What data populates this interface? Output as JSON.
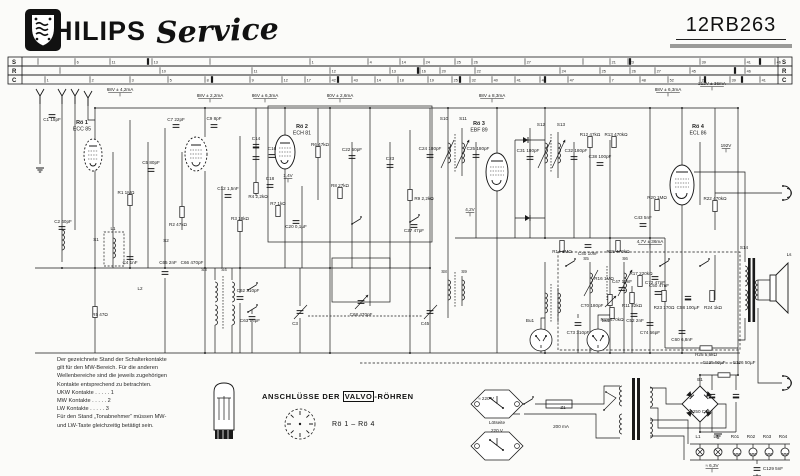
{
  "header": {
    "brand": "PHILIPS",
    "brand_script": "Service",
    "model": "12RB263"
  },
  "ruler": {
    "rows": [
      {
        "label": "S",
        "ticks": [
          [
            38,
            ""
          ],
          [
            75,
            "6"
          ],
          [
            110,
            "11"
          ],
          [
            152,
            "13"
          ],
          [
            210,
            ""
          ],
          [
            310,
            "1"
          ],
          [
            368,
            "4"
          ],
          [
            400,
            "14"
          ],
          [
            424,
            "24"
          ],
          [
            455,
            "25"
          ],
          [
            472,
            "26"
          ],
          [
            525,
            "27"
          ],
          [
            583,
            ""
          ],
          [
            610,
            "21"
          ],
          [
            628,
            "23"
          ],
          [
            700,
            "39"
          ],
          [
            745,
            "41"
          ],
          [
            775,
            "46"
          ]
        ],
        "heavy": [
          148,
          630,
          760
        ]
      },
      {
        "label": "R",
        "ticks": [
          [
            60,
            ""
          ],
          [
            160,
            "10"
          ],
          [
            252,
            "11"
          ],
          [
            330,
            "12"
          ],
          [
            390,
            "13"
          ],
          [
            420,
            "16"
          ],
          [
            440,
            "20"
          ],
          [
            475,
            "22"
          ],
          [
            560,
            "24"
          ],
          [
            600,
            "25"
          ],
          [
            630,
            "26"
          ],
          [
            655,
            "27"
          ],
          [
            690,
            "45"
          ],
          [
            745,
            "46"
          ]
        ],
        "heavy": [
          418,
          735
        ]
      },
      {
        "label": "C",
        "ticks": [
          [
            45,
            "1"
          ],
          [
            90,
            "2"
          ],
          [
            130,
            "3"
          ],
          [
            168,
            "5"
          ],
          [
            205,
            "8"
          ],
          [
            250,
            "9"
          ],
          [
            282,
            "12"
          ],
          [
            305,
            "17"
          ],
          [
            330,
            "42"
          ],
          [
            352,
            "43"
          ],
          [
            375,
            "14"
          ],
          [
            398,
            "18"
          ],
          [
            428,
            "19"
          ],
          [
            452,
            "25"
          ],
          [
            470,
            "32"
          ],
          [
            492,
            "40"
          ],
          [
            515,
            "41"
          ],
          [
            540,
            "44"
          ],
          [
            568,
            "47"
          ],
          [
            610,
            "7"
          ],
          [
            640,
            "48"
          ],
          [
            668,
            "52"
          ],
          [
            700,
            "27"
          ],
          [
            730,
            "39"
          ],
          [
            760,
            "41"
          ]
        ],
        "heavy": [
          212,
          338,
          460,
          545,
          705,
          742
        ]
      }
    ]
  },
  "schematic": {
    "tubes": [
      {
        "x": 82,
        "y": 124,
        "ref": "Rö 1",
        "type": "ECC 85"
      },
      {
        "x": 302,
        "y": 128,
        "ref": "Rö 2",
        "type": "ECH 81"
      },
      {
        "x": 479,
        "y": 125,
        "ref": "Rö 3",
        "type": "EBF 89"
      },
      {
        "x": 698,
        "y": 128,
        "ref": "Rö 4",
        "type": "ECL 86"
      }
    ],
    "annotations": [
      [
        120,
        91,
        "68V ± 4,2mA"
      ],
      [
        210,
        97,
        "88V ± 2,2mA"
      ],
      [
        265,
        97,
        "86V ± 6,3mA"
      ],
      [
        340,
        97,
        "80V ± 2,6mA"
      ],
      [
        492,
        97,
        "88V ± 8,3mA"
      ],
      [
        668,
        91,
        "88V ± 6,3mA"
      ],
      [
        712,
        85,
        "212V ± 36mA"
      ],
      [
        726,
        147,
        "192V"
      ],
      [
        650,
        243,
        "4,7V ± 36mA"
      ],
      [
        288,
        177,
        "1,4V"
      ],
      [
        470,
        211,
        "4,2V"
      ],
      [
        712,
        467,
        "≈ 6,3V"
      ]
    ],
    "labels": [
      [
        52,
        121,
        "C1 15pF"
      ],
      [
        63,
        223,
        "C2 40pF"
      ],
      [
        96,
        241,
        "S1"
      ],
      [
        113,
        230,
        "L1"
      ],
      [
        126,
        194,
        "R1 1MΩ"
      ],
      [
        130,
        264,
        "C4 1nF"
      ],
      [
        151,
        164,
        "C5 80pF"
      ],
      [
        166,
        242,
        "S2"
      ],
      [
        176,
        121,
        "C7 22pF"
      ],
      [
        178,
        226,
        "R2 47kΩ"
      ],
      [
        214,
        120,
        "C9 8pF"
      ],
      [
        228,
        190,
        "C12 1,5nF"
      ],
      [
        240,
        220,
        "R3 18kΩ"
      ],
      [
        256,
        140,
        "C14"
      ],
      [
        258,
        198,
        "R4 2,2kΩ"
      ],
      [
        272,
        150,
        "C16"
      ],
      [
        320,
        146,
        "R6 47kΩ"
      ],
      [
        270,
        180,
        "C18"
      ],
      [
        278,
        205,
        "R7 1kΩ"
      ],
      [
        296,
        228,
        "C20 0,1µF"
      ],
      [
        340,
        187,
        "R8 27kΩ"
      ],
      [
        352,
        151,
        "C22 50pF"
      ],
      [
        390,
        160,
        "C23"
      ],
      [
        444,
        120,
        "S10"
      ],
      [
        463,
        120,
        "S11"
      ],
      [
        430,
        150,
        "C24 180pF"
      ],
      [
        478,
        150,
        "C25 180pF"
      ],
      [
        424,
        200,
        "R9 2,2kΩ"
      ],
      [
        414,
        232,
        "C27 47pF"
      ],
      [
        541,
        126,
        "S12"
      ],
      [
        561,
        126,
        "S13"
      ],
      [
        528,
        152,
        "C31 180pF"
      ],
      [
        576,
        152,
        "C32 180pF"
      ],
      [
        590,
        136,
        "R12 47kΩ"
      ],
      [
        616,
        136,
        "R13 470kΩ"
      ],
      [
        600,
        158,
        "C38 100pF"
      ],
      [
        562,
        253,
        "R14 1MΩ"
      ],
      [
        588,
        255,
        "C40 10nF"
      ],
      [
        618,
        253,
        "R15 470kΩ"
      ],
      [
        643,
        219,
        "C43 5nF"
      ],
      [
        604,
        280,
        "R16 1MΩ"
      ],
      [
        622,
        283,
        "C47 10nF"
      ],
      [
        641,
        275,
        "R17 220kΩ"
      ],
      [
        659,
        287,
        "C50 47nF"
      ],
      [
        612,
        321,
        "R18 470kΩ"
      ],
      [
        635,
        322,
        "C52 2nF"
      ],
      [
        657,
        199,
        "R20 1MΩ"
      ],
      [
        715,
        200,
        "R22 470kΩ"
      ],
      [
        664,
        309,
        "R23 170Ω"
      ],
      [
        688,
        309,
        "C58 100µF"
      ],
      [
        713,
        309,
        "R24 1kΩ"
      ],
      [
        682,
        341,
        "C60 6,8nF"
      ],
      [
        706,
        356,
        "R25 5,6kΩ"
      ],
      [
        744,
        249,
        "S14"
      ],
      [
        789,
        256,
        "Ls"
      ],
      [
        563,
        409,
        "Z1"
      ],
      [
        561,
        428,
        "200 mA"
      ],
      [
        700,
        381,
        "B1"
      ],
      [
        700,
        413,
        "E250 C75"
      ],
      [
        714,
        364,
        "C125 50µF"
      ],
      [
        744,
        364,
        "C126 50µF"
      ],
      [
        698,
        438,
        "L1"
      ],
      [
        716,
        438,
        "L2"
      ],
      [
        735,
        438,
        "Rö1"
      ],
      [
        751,
        438,
        "Rö2"
      ],
      [
        767,
        438,
        "Rö3"
      ],
      [
        783,
        438,
        "Rö4"
      ],
      [
        773,
        470,
        "C129 5nF"
      ],
      [
        497,
        424,
        "Lötseite"
      ],
      [
        497,
        432,
        "220 V"
      ],
      [
        486,
        400,
        "≈ 220 V"
      ],
      [
        204,
        271,
        "S3"
      ],
      [
        224,
        271,
        "S4"
      ],
      [
        248,
        292,
        "C62 310pF"
      ],
      [
        250,
        322,
        "C63 56pF"
      ],
      [
        100,
        316,
        "R5 47Ω"
      ],
      [
        140,
        290,
        "L2"
      ],
      [
        168,
        264,
        "C65 2nF"
      ],
      [
        192,
        264,
        "C66 470pF"
      ],
      [
        361,
        316,
        "C68 470pF"
      ],
      [
        295,
        325,
        "C3"
      ],
      [
        425,
        325,
        "C45"
      ],
      [
        586,
        260,
        "S5"
      ],
      [
        625,
        260,
        "S6"
      ],
      [
        592,
        307,
        "C70 180pF"
      ],
      [
        632,
        307,
        "R11 22kΩ"
      ],
      [
        655,
        284,
        "C72 47pF"
      ],
      [
        578,
        334,
        "C73 310pF"
      ],
      [
        650,
        334,
        "C74 56pF"
      ],
      [
        444,
        273,
        "S8"
      ],
      [
        464,
        273,
        "S9"
      ],
      [
        530,
        322,
        "Bu1"
      ],
      [
        606,
        322,
        "Bu2"
      ]
    ],
    "caption": {
      "pre": "ANSCHLÜSSE DER ",
      "brand": "VALVO",
      "post": "-RÖHREN",
      "range": "Rö 1 – Rö 4"
    },
    "notes": [
      "Der gezeichnete Stand der Schalterkontakte",
      "gilt für den MW-Bereich. Für die anderen",
      "Wellenbereiche sind die jeweils zugehörigen",
      "Kontakte entsprechend zu betrachten.",
      "UKW Kontakte  .  .  .  .  .  1",
      "MW Kontakte   .  .  .  .  .  2",
      "LW Kontakte   .  .  .  .  .  3",
      "Für den Stand „Tonabnehmer“ müssen MW-",
      "und LW-Taste gleichzeitig betätigt sein."
    ],
    "ink": "#1a1a1a",
    "bar_gray": "#9a9a98"
  }
}
